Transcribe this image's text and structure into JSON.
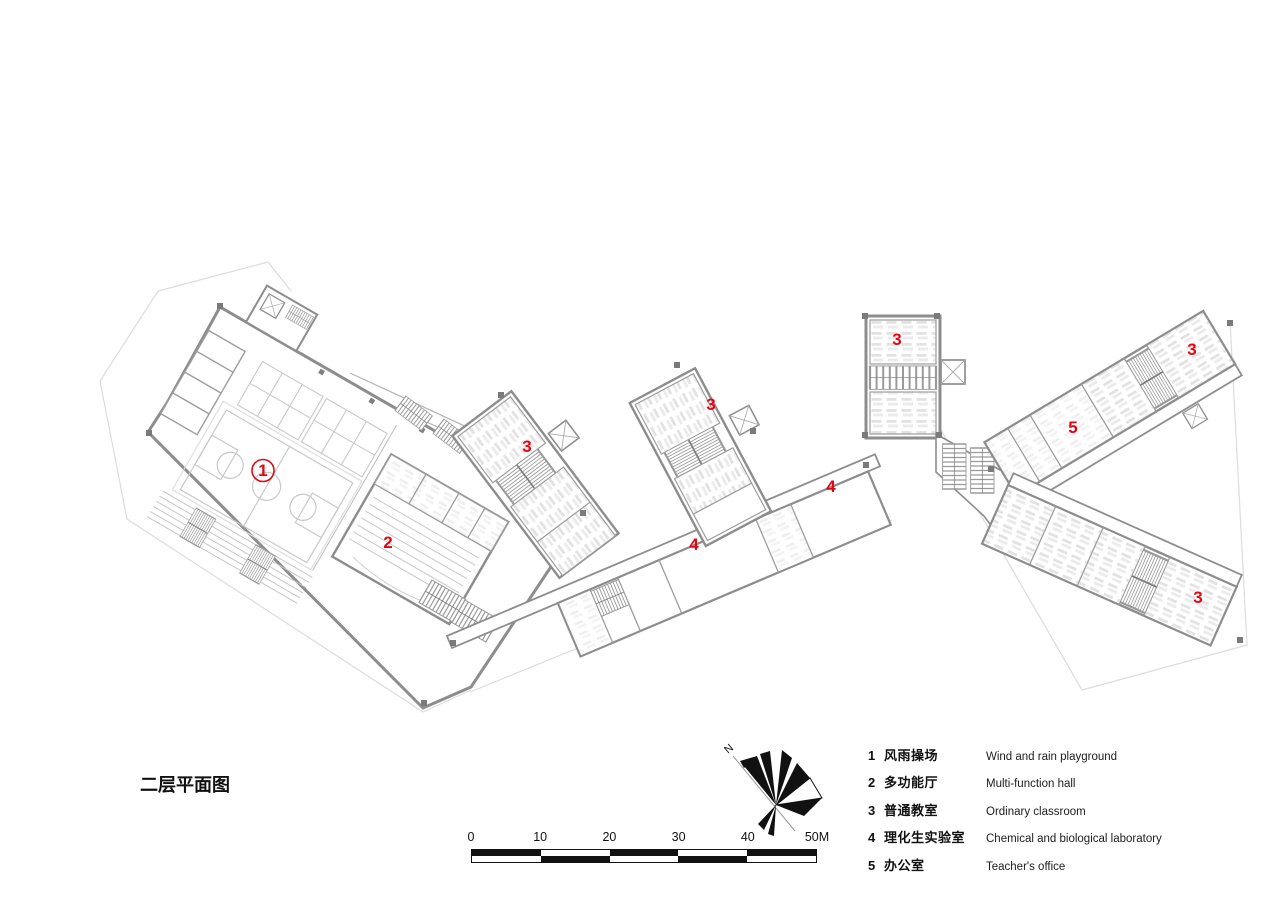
{
  "title": {
    "text": "二层平面图"
  },
  "plan": {
    "label_color": "#e30613",
    "labels": [
      {
        "id": "room-1",
        "text": "1",
        "x": 263,
        "y": 476,
        "circled": true
      },
      {
        "id": "room-2",
        "text": "2",
        "x": 388,
        "y": 548,
        "circled": false
      },
      {
        "id": "room-3a",
        "text": "3",
        "x": 527,
        "y": 452,
        "circled": false
      },
      {
        "id": "room-3b",
        "text": "3",
        "x": 711,
        "y": 410,
        "circled": false
      },
      {
        "id": "room-3c",
        "text": "3",
        "x": 897,
        "y": 345,
        "circled": false
      },
      {
        "id": "room-3d",
        "text": "3",
        "x": 1192,
        "y": 355,
        "circled": false
      },
      {
        "id": "room-3e",
        "text": "3",
        "x": 1198,
        "y": 603,
        "circled": false
      },
      {
        "id": "room-4a",
        "text": "4",
        "x": 694,
        "y": 550,
        "circled": false
      },
      {
        "id": "room-4b",
        "text": "4",
        "x": 831,
        "y": 492,
        "circled": false
      },
      {
        "id": "room-5",
        "text": "5",
        "x": 1073,
        "y": 433,
        "circled": false
      }
    ]
  },
  "north_arrow": {
    "label": "N"
  },
  "scale_bar": {
    "labels": [
      "0",
      "10",
      "20",
      "30",
      "40",
      "50M"
    ]
  },
  "legend": {
    "items": [
      {
        "num": "1",
        "zh": "风雨操场",
        "en": "Wind and rain playground"
      },
      {
        "num": "2",
        "zh": "多功能厅",
        "en": "Multi-function hall"
      },
      {
        "num": "3",
        "zh": "普通教室",
        "en": "Ordinary classroom"
      },
      {
        "num": "4",
        "zh": "理化生实验室",
        "en": "Chemical and biological laboratory"
      },
      {
        "num": "5",
        "zh": "办公室",
        "en": "Teacher's office"
      }
    ]
  }
}
